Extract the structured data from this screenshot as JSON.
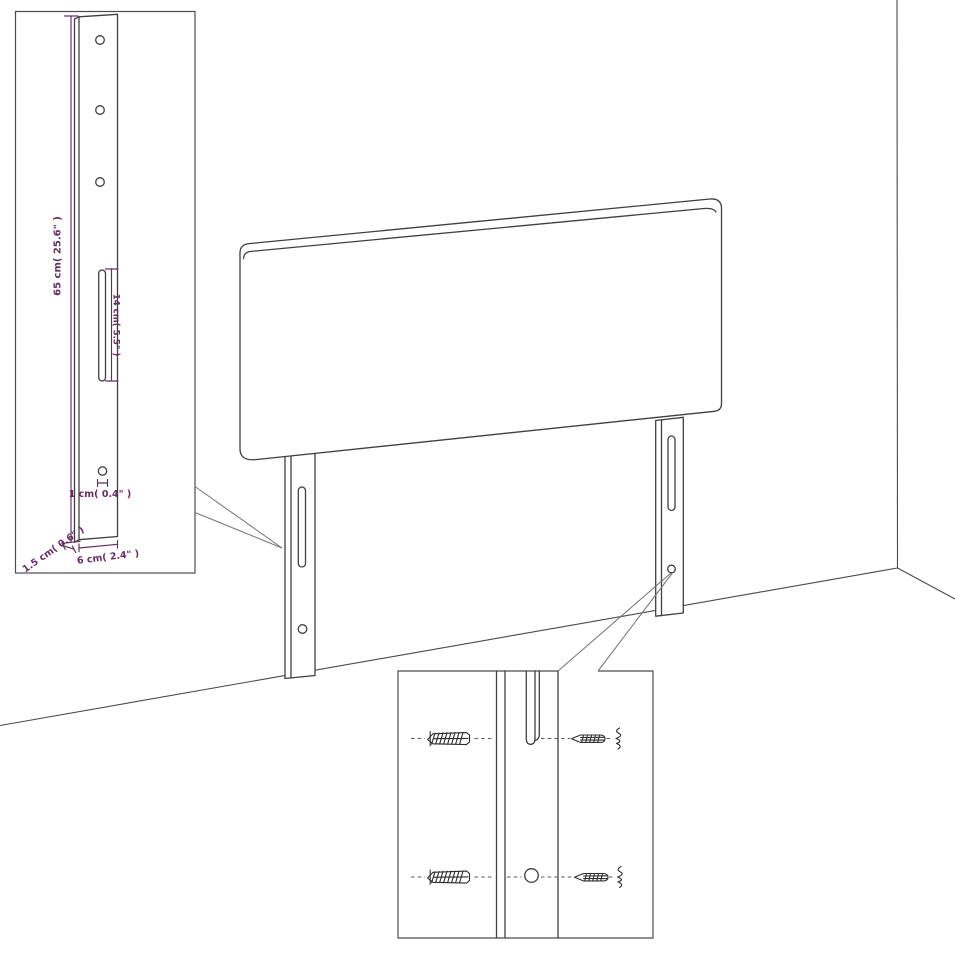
{
  "page": {
    "background": "#ffffff",
    "description": "Assembly dimension diagram of an upholstered headboard with two rear mounting legs, shown in a room corner, with a zoomed leg detail inset and a wall-anchor / screw mounting detail inset"
  },
  "colors": {
    "line": "#3f3f3f",
    "box_border": "#4c4c4c",
    "leader_line": "#767676",
    "dimension": "#662d60",
    "hardware": "#2d2d2d"
  },
  "parts": {
    "panel": "headboard-panel",
    "leg": "mounting-leg",
    "anchor": "wall-anchor",
    "screw": "mounting-screw",
    "slot": "keyhole-slot",
    "hole": "screw-hole"
  },
  "inset_leg_detail": {
    "dim_height_label": "65 cm( 25.6\" )",
    "dim_slot_label": "14 cm( 5.5\" )",
    "dim_hole_label": "1 cm( 0.4\" )",
    "dim_depth_label": "1.5 cm( 0.6\" )",
    "dim_width_label": "6 cm( 2.4\" )"
  }
}
